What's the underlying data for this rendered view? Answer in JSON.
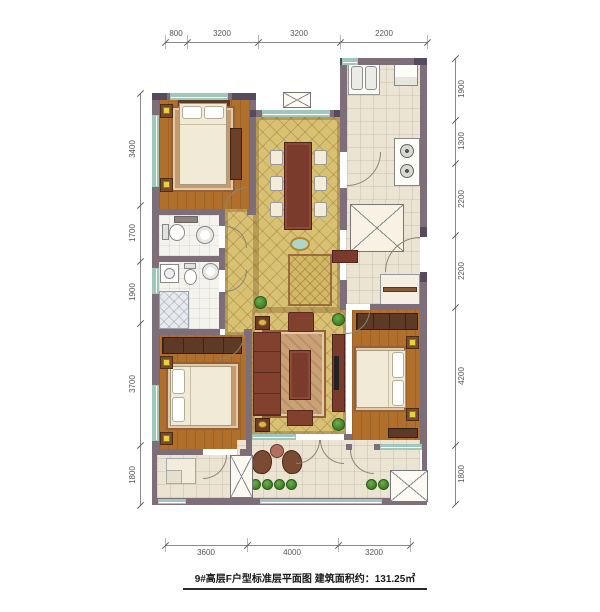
{
  "caption": "9#高层F户型标准层平面图 建筑面积约：131.25㎡",
  "dimensions": {
    "top": [
      "800",
      "3200",
      "3200",
      "2200"
    ],
    "bottom": [
      "3600",
      "4000",
      "3200"
    ],
    "left": [
      "3400",
      "1700",
      "1900",
      "3700",
      "1800"
    ],
    "right": [
      "1900",
      "1300",
      "2200",
      "2200",
      "4200",
      "1800"
    ]
  },
  "colors": {
    "wall": "#7e6e7a",
    "wall_dark": "#554a5e",
    "wood": "#b0702c",
    "tile_gold": "#d8c172",
    "tile_cream": "#ece4d2",
    "window": "#9fc8ba",
    "furniture": "#7a3a2c",
    "sofa": "#82402f",
    "wardrobe": "#5d3a26",
    "bed": "#f0ead6",
    "rug": "#c49a6e",
    "lamp": "#e6d33c",
    "plant": "#3f7d28"
  }
}
